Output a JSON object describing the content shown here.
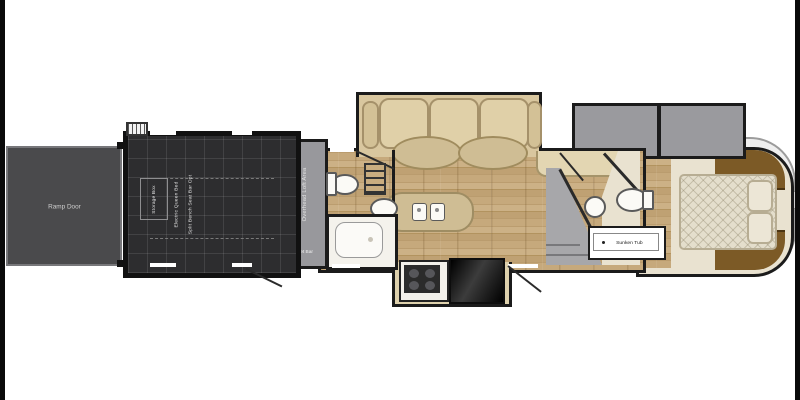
{
  "title": "Fifth-wheel toy hauler RV floor plan",
  "labels": {
    "ramp_door": "Ramp Door",
    "storage_box": "Storage Box",
    "garage_option_1": "Electric Queen Bed",
    "garage_option_2": "Split Bench Seat Bar Opt",
    "overhead_loft": "Overhead Loft Area",
    "wet_bar": "Wet Bar",
    "tub": "Sunken Tub"
  },
  "colors": {
    "wall": "#1b1b1b",
    "garage_floor": "#2d2d2f",
    "ramp_door": "#4a4a4c",
    "loft_strip": "#98989c",
    "slide_gray": "#9a9a9e",
    "wood_floor": "#bfa173",
    "bedroom_floor": "#e9e2d0",
    "cabinet_brown": "#7c5a26",
    "cushion_tan": "#e0d0a8",
    "fixture_white": "#fbfaf6"
  }
}
